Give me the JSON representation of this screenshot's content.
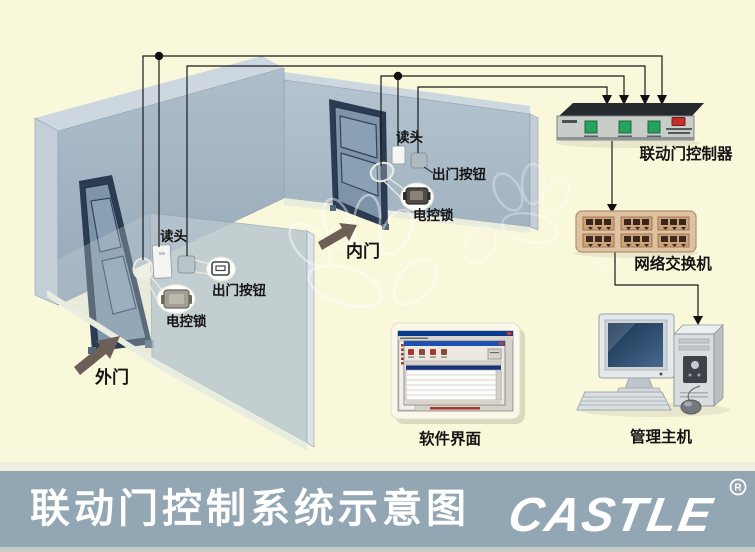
{
  "title_bar": {
    "title": "联动门控制系统示意图",
    "logo_text": "CASTLE",
    "registered_mark": "R"
  },
  "room": {
    "outer_door_label": "外门",
    "inner_door_label": "内门"
  },
  "door_devices": {
    "outer": {
      "reader": "读头",
      "exit_button": "出门按钮",
      "electric_lock": "电控锁"
    },
    "inner": {
      "reader": "读头",
      "exit_button": "出门按钮",
      "electric_lock": "电控锁"
    }
  },
  "equipment": {
    "controller_label": "联动门控制器",
    "switch_label": "网络交换机",
    "software_label": "软件界面",
    "host_label": "管理主机"
  },
  "colors": {
    "background": "#FAF8DB",
    "wall": "#A0B1C0",
    "wall_light": "#CDD7E0",
    "partition": "#B8C5CF",
    "door_frame": "#2B3B52",
    "door_panel": "#7E94A9",
    "bottom_bar": "#92A6B4",
    "controller_button_green": "#27A25D",
    "controller_led_red": "#C03028",
    "switch_body": "#DEC2A2",
    "wire": "#1A1A1A"
  }
}
